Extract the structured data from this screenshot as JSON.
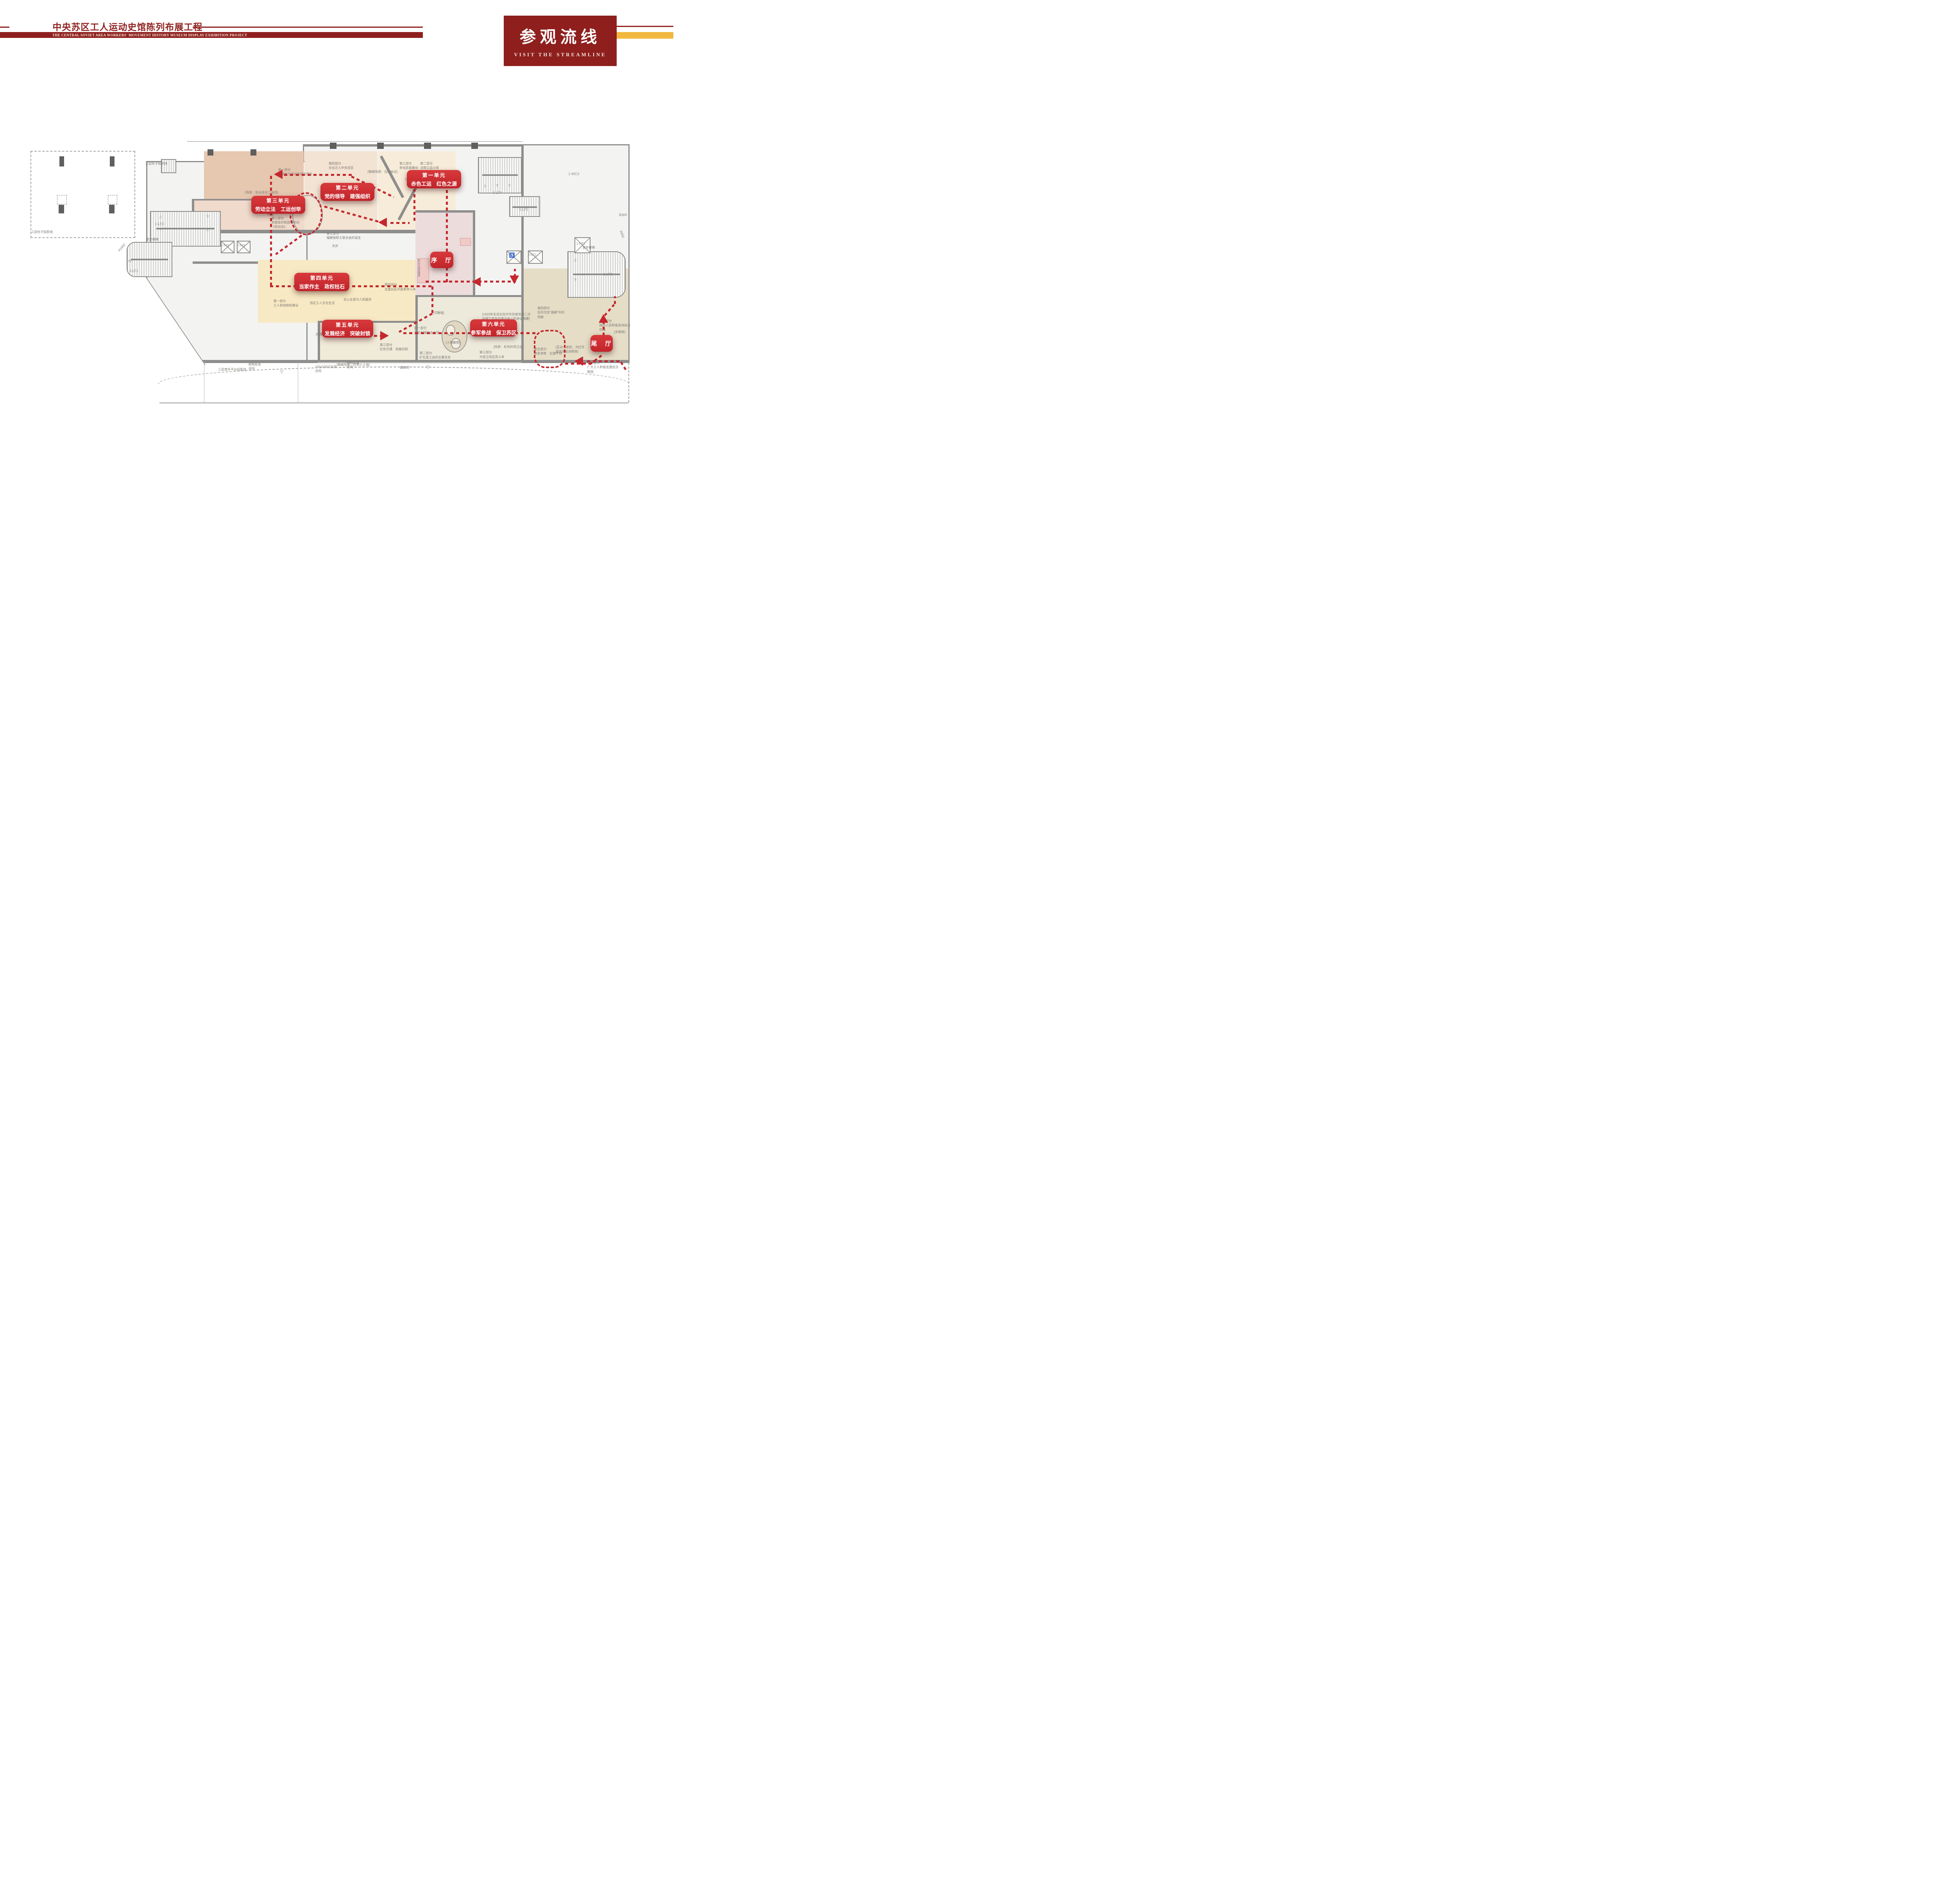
{
  "header": {
    "title_zh": "中央苏区工人运动史馆陈列布展工程",
    "title_en": "THE CENTRAL SOVIET AREA WORKERS' MOVEMENT HISTORY MUSEUM DISPLAY EXHIBITION PROJECT",
    "section_title_zh": "参观流线",
    "section_title_en": "VISIT THE STREAMLINE"
  },
  "colors": {
    "brand_maroon": "#8e1f1d",
    "accent_gold": "#f2b83d",
    "badge_red": "#cf2b30",
    "route_red": "#c4282d"
  },
  "route": {
    "stops": [
      {
        "name": "第一单元",
        "theme": "赤色工运　红色之源"
      },
      {
        "name": "第二单元",
        "theme": "党的领导　建强组织"
      },
      {
        "name": "第三单元",
        "theme": "劳动立法　工运创举"
      },
      {
        "name": "第四单元",
        "theme": "当家作主　政权柱石"
      },
      {
        "name": "第五单元",
        "theme": "发展经济　突破封锁"
      },
      {
        "name": "第六单元",
        "theme": "参军参战　保卫苏区"
      },
      {
        "name": "序　厅"
      },
      {
        "name": "尾　厅"
      }
    ]
  },
  "plan": {
    "annotations": [
      "三层柱子投影线",
      "三层柱子投影线",
      "第一部分\n早期地方劳动法规的产生",
      "第四部分\n全总迁入中央苏区",
      "[微缩场景：古田会议]",
      "第三部分\n参加武装暴动",
      "[半景画]",
      "第二部分\n点燃工运火炬",
      "[场景：陈云在长汀指导]",
      "第二部分\n工会在实施劳动法规的\n作用",
      "第三部分\n苏维埃共和国颁布的\n《劳动法》",
      "第三部分\n福建省职工联合会的诞生",
      "第四部分\n支援白区开展革命斗争",
      "[浮雕墙]",
      "第一部分\n苏区创建的主力军",
      "[人物雕塑]",
      "[1933年毛泽东在中华苏维埃第二次\n全国工农兵代表大会上的讲话摘要]",
      "[陈云在闽西雕像]",
      "天井",
      "苏区工人文化生活",
      "全心全意为人民服务",
      "第一部分\n工人参加政权建设",
      "第一部分\n广泛开展合作社运动",
      "[场景：造纸、打铁]",
      "[微缩场景：红色小上海]",
      "第三部分\n红色交通　突破封锁",
      "第二部分\n扩红是工会的主要任务",
      "第三部分\n为保卫苏区而斗争",
      "[场景：松毛岭保卫战]",
      "第五部分\n艰苦卓绝　红旗不倒",
      "第四部分\n在历次反“围剿”中的\n贡献",
      "[互动：架桥、为红军\n游击队运送物资]",
      "第二部分\n闽西人民积极支持前方\n抗战",
      "[多媒体]",
      "第一部分\n广大工人积极支援抗日\n救国",
      "三层室外平台投影线",
      "结构反梁\n余同",
      "结构反梁\n余同",
      "100x100过水洞\n余同",
      "最高点",
      "室外楼梯",
      "R1900",
      "室外楼梯",
      "R950",
      "75°",
      "清洁间",
      "▽",
      "▽"
    ],
    "room_labels": {
      "lt1": "1-LT1",
      "lt2": "1-LT2",
      "lt3": "1-LT3",
      "lt4": "1-LT4",
      "lt5": "1-LT5",
      "dt1": "1-DT1",
      "dt2": "1-DT2",
      "dt3": "1-DT3",
      "dt4": "1-DT4",
      "wc3": "1-WC3",
      "ht1": "1-HT1"
    },
    "updown": {
      "up": "上",
      "down": "下"
    },
    "icons": {
      "wheelchair": "♿"
    }
  }
}
